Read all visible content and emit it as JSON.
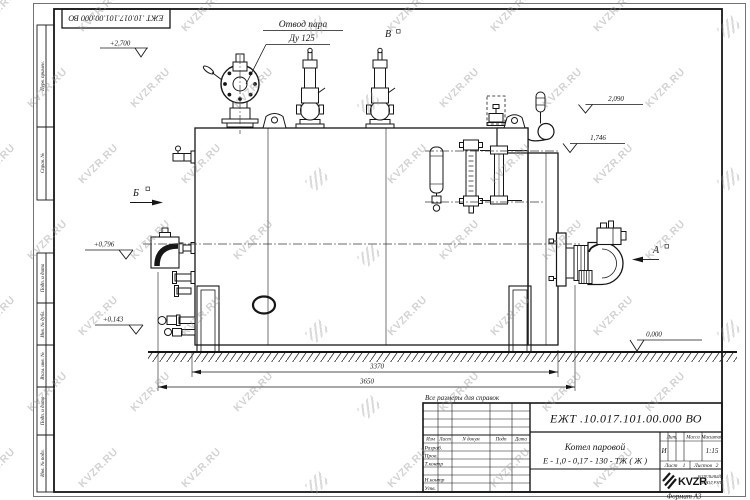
{
  "watermark": {
    "text": "KVZR.RU"
  },
  "stamp_top": {
    "designation": "ЕЖТ .10.017.101.00.000  ВО"
  },
  "notes": {
    "reference": "Все размеры для справок",
    "format": "Формат  А3"
  },
  "steam_label": {
    "line1": "Отвод пара",
    "line2": "Ду 125"
  },
  "views": {
    "a": "А",
    "b": "Б",
    "v": "В"
  },
  "elevations": {
    "top": "+2,700",
    "gauge": "2,090",
    "rear": "1,746",
    "feed": "+0,796",
    "drain": "+0,143",
    "ground": "0,000"
  },
  "dims": {
    "shell": "3370",
    "overall": "3650"
  },
  "title_block": {
    "designation": "ЕЖТ .10.017.101.00.000  ВО",
    "product_line1": "Котел паровой",
    "product_line2": "Е - 1,0 - 0,17 - 130 - ТЖ ( Ж )",
    "col_izm": "Изм",
    "col_list": "Лист",
    "col_ndok": "N докум",
    "col_podp": "Подп",
    "col_data": "Дата",
    "row_razrab": "Разраб.",
    "row_prov": "Пров.",
    "row_tkontr": "Т.контр",
    "row_nkontr": "Н.контр",
    "row_utv": "Утв.",
    "lit_header": "Лит.",
    "mass_header": "Масса",
    "scale_header": "Масштаб",
    "lit_value": "И",
    "scale_value": "1:15",
    "sheet_label": "Лист",
    "sheet_value": "1",
    "sheets_label": "Листов",
    "sheets_value": "2",
    "logo_brand": "KVZR",
    "logo_sub1": "КОТЕЛЬНЫЙ",
    "logo_sub2": "ЗАВОД РЭП"
  },
  "margin_labels": [
    "Перв. примен.",
    "Справ. №",
    "Подп. и дата",
    "Инв. № дубл.",
    "Взам. инв. №",
    "Подп. и дата",
    "Инв. № подл."
  ]
}
